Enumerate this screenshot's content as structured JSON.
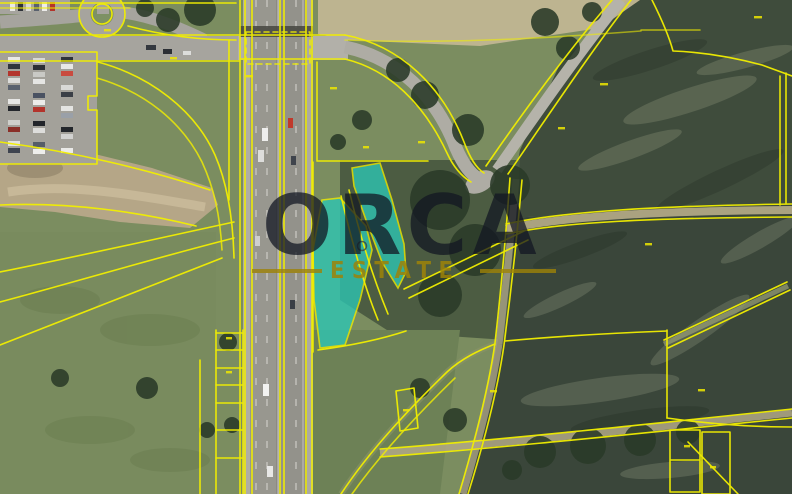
{
  "watermark": {
    "brand": "ORCA",
    "subtitle": "ESTATE"
  },
  "map": {
    "type": "cadastral-satellite-view",
    "boundary_line_color": "#f2ef00",
    "highlight_parcel_color": "#2cc7b5"
  }
}
